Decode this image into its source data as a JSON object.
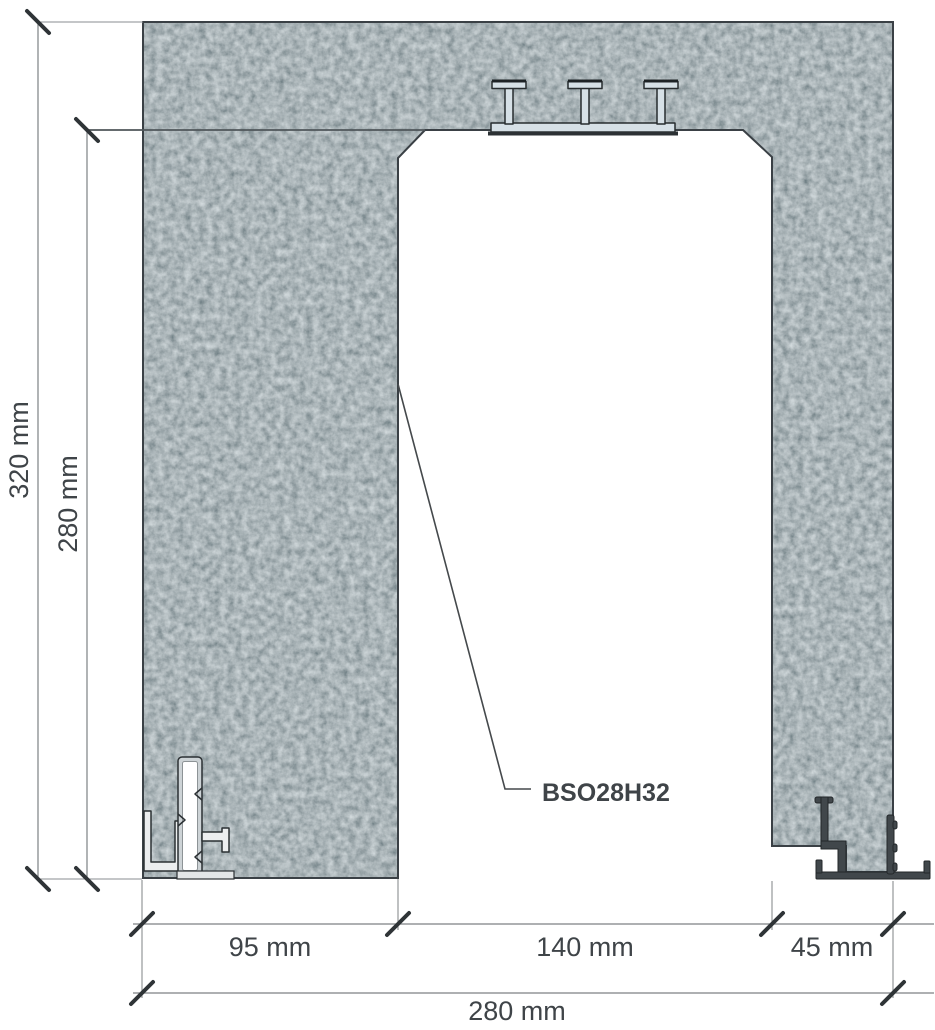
{
  "drawing": {
    "profile_label": "BSO28H32",
    "dims": {
      "total_height": "320 mm",
      "opening_height": "280 mm",
      "left_jamb": "95 mm",
      "opening_width": "140 mm",
      "right_jamb": "45 mm",
      "total_width": "280 mm"
    },
    "colors": {
      "concrete_base": "#637075",
      "section_outline": "#3a4045",
      "dimension_lines": "#7d8184",
      "dimension_text": "#3f4448",
      "steel_light": "#d6e0e6",
      "steel_dark": "#41474b"
    }
  }
}
